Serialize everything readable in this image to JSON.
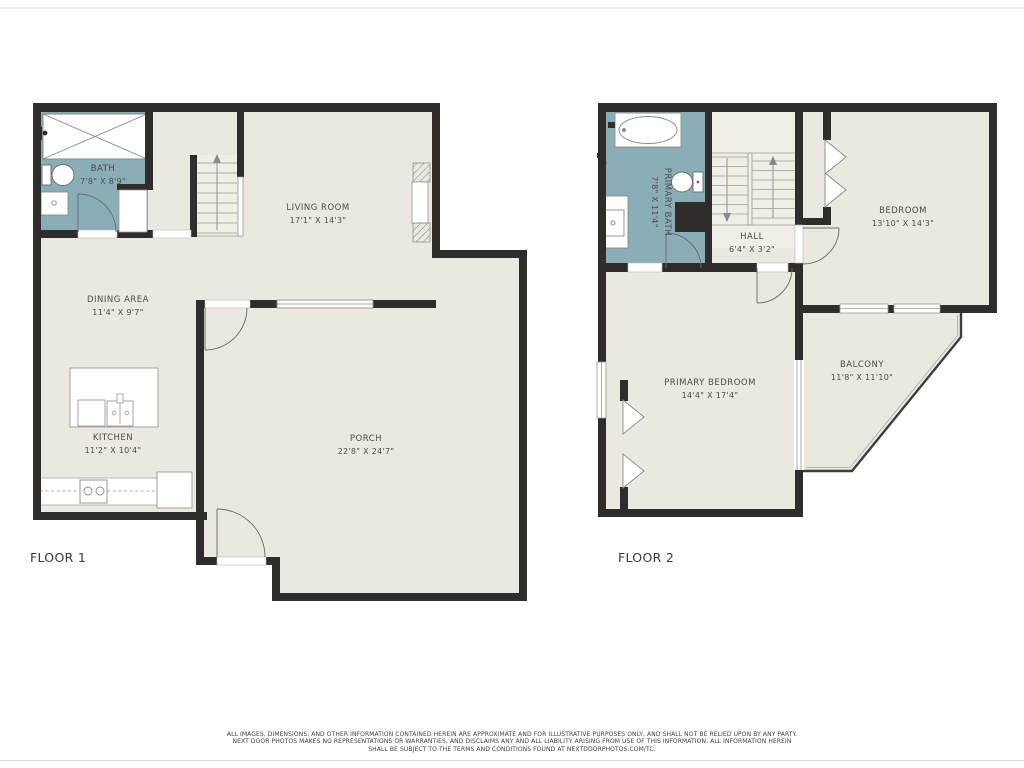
{
  "colors": {
    "wall": "#2e2d2b",
    "floor": "#eae8e0",
    "wet_room": "#8badb8"
  },
  "floor1": {
    "label": "FLOOR 1",
    "rooms": {
      "bath": {
        "name": "BATH",
        "dims": "7'8\" X 8'9\""
      },
      "living_room": {
        "name": "LIVING ROOM",
        "dims": "17'1\" X 14'3\""
      },
      "dining_area": {
        "name": "DINING AREA",
        "dims": "11'4\" X 9'7\""
      },
      "kitchen": {
        "name": "KITCHEN",
        "dims": "11'2\" X 10'4\""
      },
      "porch": {
        "name": "PORCH",
        "dims": "22'8\" X 24'7\""
      }
    }
  },
  "floor2": {
    "label": "FLOOR 2",
    "rooms": {
      "primary_bath": {
        "name": "PRIMARY BATH",
        "dims": "7'8\" X 11'4\""
      },
      "hall": {
        "name": "HALL",
        "dims": "6'4\" X 3'2\""
      },
      "bedroom": {
        "name": "BEDROOM",
        "dims": "13'10\" X 14'3\""
      },
      "primary_bedroom": {
        "name": "PRIMARY BEDROOM",
        "dims": "14'4\" X 17'4\""
      },
      "balcony": {
        "name": "BALCONY",
        "dims": "11'8\" X 11'10\""
      }
    }
  },
  "disclaimer": {
    "line1": "ALL IMAGES, DIMENSIONS, AND OTHER INFORMATION CONTAINED HEREIN ARE APPROXIMATE AND FOR ILLUSTRATIVE PURPOSES ONLY, AND SHALL NOT BE RELIED UPON BY ANY PARTY.",
    "line2": "NEXT DOOR PHOTOS MAKES NO REPRESENTATIONS OR WARRANTIES, AND DISCLAIMS ANY AND ALL LIABILITY ARISING FROM USE OF THIS INFORMATION. ALL INFORMATION HEREIN",
    "line3": "SHALL BE SUBJECT TO THE TERMS AND CONDITIONS FOUND AT NEXTDOORPHOTOS.COM/TC."
  }
}
